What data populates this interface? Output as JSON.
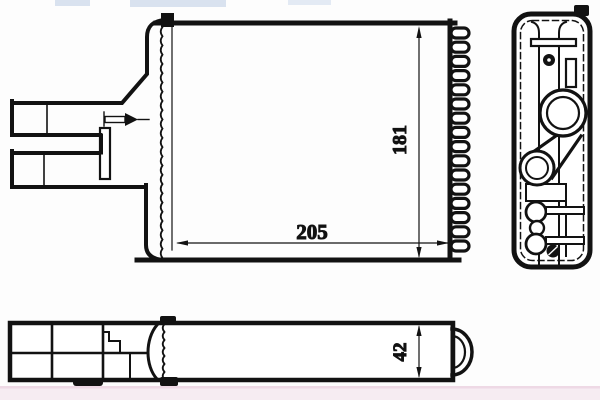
{
  "drawing": {
    "dimensions": {
      "core_height": "181",
      "core_width": "205",
      "core_depth": "42"
    },
    "icons": {
      "flow_direction_arrow": "→"
    },
    "colors": {
      "line": "#121212",
      "background": "#fdfdfd",
      "watermark_top": "#d9e2ef",
      "watermark_bottom_band": "#f6ecf2",
      "watermark_bottom_line": "#eed9e5"
    }
  }
}
